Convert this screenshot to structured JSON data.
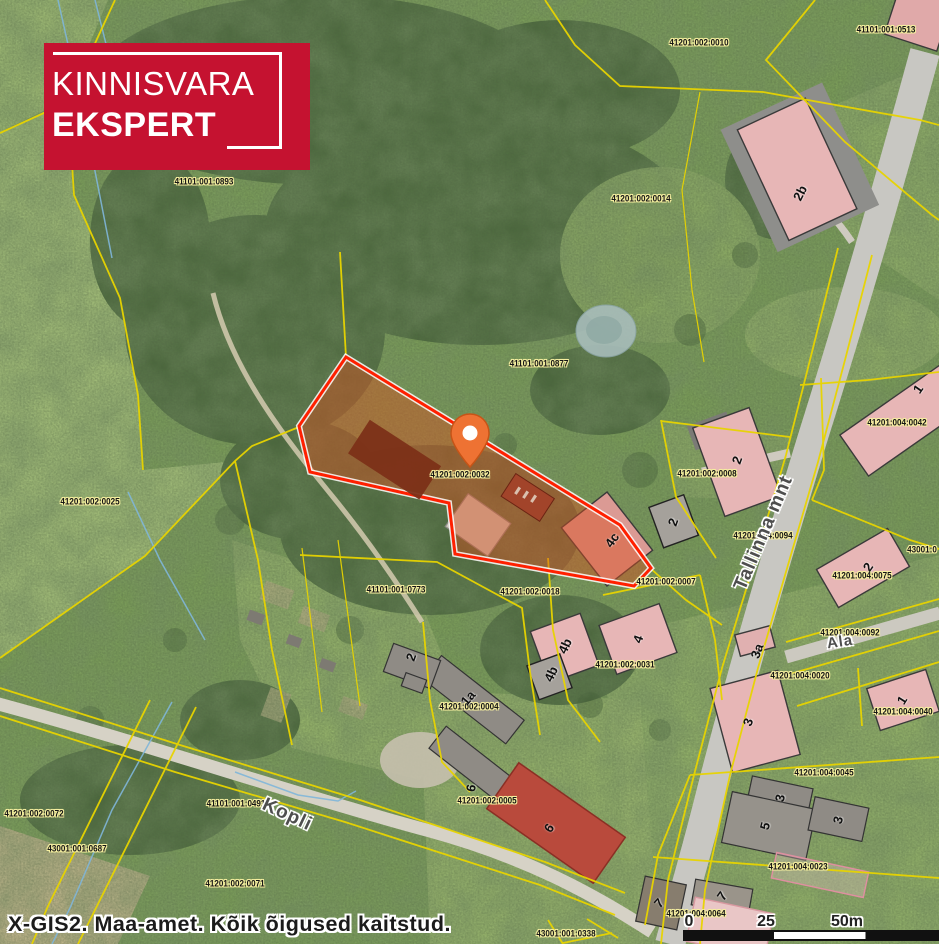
{
  "branding": {
    "line1": "KINNISVARA",
    "line2": "EKSPERT"
  },
  "attribution": "X-GIS2. Maa-amet. Kõik õigused kaitstud.",
  "scale_bar": {
    "t0": "0",
    "t1": "25",
    "t2": "50m"
  },
  "colors": {
    "logo_bg": "#c51230",
    "boundary_yellow": "#e8d400",
    "parcel_outline": "#ff2000",
    "parcel_fill": "#d94f20",
    "pin_orange": "#ee7233"
  },
  "map": {
    "selected_parcel": "41201:002:0032",
    "cadastral_labels": [
      {
        "text": "41201:002:0010",
        "x": 699,
        "y": 43
      },
      {
        "text": "41101:001:0513",
        "x": 886,
        "y": 30
      },
      {
        "text": "41101:001:0893",
        "x": 204,
        "y": 182
      },
      {
        "text": "41201:002:0014",
        "x": 641,
        "y": 199
      },
      {
        "text": "41101:001:0877",
        "x": 539,
        "y": 364
      },
      {
        "text": "41201:004:0042",
        "x": 897,
        "y": 423
      },
      {
        "text": "41201:002:0008",
        "x": 707,
        "y": 474
      },
      {
        "text": "41201:002:0032",
        "x": 460,
        "y": 475
      },
      {
        "text": "41201:002:0025",
        "x": 90,
        "y": 502
      },
      {
        "text": "41201:004:0094",
        "x": 763,
        "y": 536
      },
      {
        "text": "43001:0",
        "x": 922,
        "y": 550
      },
      {
        "text": "41201:004:0075",
        "x": 862,
        "y": 576
      },
      {
        "text": "41201:002:0007",
        "x": 666,
        "y": 582
      },
      {
        "text": "41101:001:0773",
        "x": 396,
        "y": 590
      },
      {
        "text": "41201:002:0018",
        "x": 530,
        "y": 592
      },
      {
        "text": "41201:004:0092",
        "x": 850,
        "y": 633
      },
      {
        "text": "41201:002:0031",
        "x": 625,
        "y": 665
      },
      {
        "text": "41201:004:0020",
        "x": 800,
        "y": 676
      },
      {
        "text": "41201:002:0004",
        "x": 469,
        "y": 707
      },
      {
        "text": "41201:004:0040",
        "x": 903,
        "y": 712
      },
      {
        "text": "41201:004:0045",
        "x": 824,
        "y": 773
      },
      {
        "text": "41201:002:0005",
        "x": 487,
        "y": 801
      },
      {
        "text": "41101:001:0491",
        "x": 236,
        "y": 804
      },
      {
        "text": "41201:002:0072",
        "x": 34,
        "y": 814
      },
      {
        "text": "43001:001:0687",
        "x": 77,
        "y": 849
      },
      {
        "text": "41201:004:0023",
        "x": 798,
        "y": 867
      },
      {
        "text": "41201:002:0071",
        "x": 235,
        "y": 884
      },
      {
        "text": "41201:004:0064",
        "x": 696,
        "y": 914
      },
      {
        "text": "43001:001:0338",
        "x": 566,
        "y": 934
      }
    ],
    "street_labels": [
      {
        "text": "Tallinna mnt",
        "x": 764,
        "y": 533,
        "rot": -67,
        "size": 19
      },
      {
        "text": "Kopli",
        "x": 287,
        "y": 815,
        "rot": 25,
        "size": 19
      },
      {
        "text": "Ala",
        "x": 840,
        "y": 642,
        "rot": -8,
        "size": 15
      }
    ],
    "building_labels": [
      {
        "text": "2b",
        "x": 800,
        "y": 193,
        "rot": -63
      },
      {
        "text": "1",
        "x": 918,
        "y": 389,
        "rot": -55
      },
      {
        "text": "2",
        "x": 737,
        "y": 460,
        "rot": -70
      },
      {
        "text": "2",
        "x": 673,
        "y": 522,
        "rot": -70
      },
      {
        "text": "4c",
        "x": 612,
        "y": 540,
        "rot": -55
      },
      {
        "text": "2",
        "x": 868,
        "y": 567,
        "rot": -55
      },
      {
        "text": "4b",
        "x": 565,
        "y": 646,
        "rot": -65
      },
      {
        "text": "4",
        "x": 638,
        "y": 639,
        "rot": -70
      },
      {
        "text": "3a",
        "x": 757,
        "y": 651,
        "rot": -70
      },
      {
        "text": "4b",
        "x": 551,
        "y": 674,
        "rot": -65
      },
      {
        "text": "2",
        "x": 411,
        "y": 657,
        "rot": -70
      },
      {
        "text": "1a",
        "x": 468,
        "y": 698,
        "rot": -50
      },
      {
        "text": "1",
        "x": 902,
        "y": 700,
        "rot": -58
      },
      {
        "text": "3",
        "x": 748,
        "y": 722,
        "rot": -70
      },
      {
        "text": "6",
        "x": 471,
        "y": 788,
        "rot": -80
      },
      {
        "text": "3",
        "x": 780,
        "y": 798,
        "rot": -78
      },
      {
        "text": "3",
        "x": 838,
        "y": 820,
        "rot": -75
      },
      {
        "text": "5",
        "x": 765,
        "y": 826,
        "rot": -75
      },
      {
        "text": "6",
        "x": 549,
        "y": 828,
        "rot": -55
      },
      {
        "text": "7",
        "x": 722,
        "y": 896,
        "rot": -55
      },
      {
        "text": "7",
        "x": 659,
        "y": 903,
        "rot": -48
      }
    ]
  }
}
